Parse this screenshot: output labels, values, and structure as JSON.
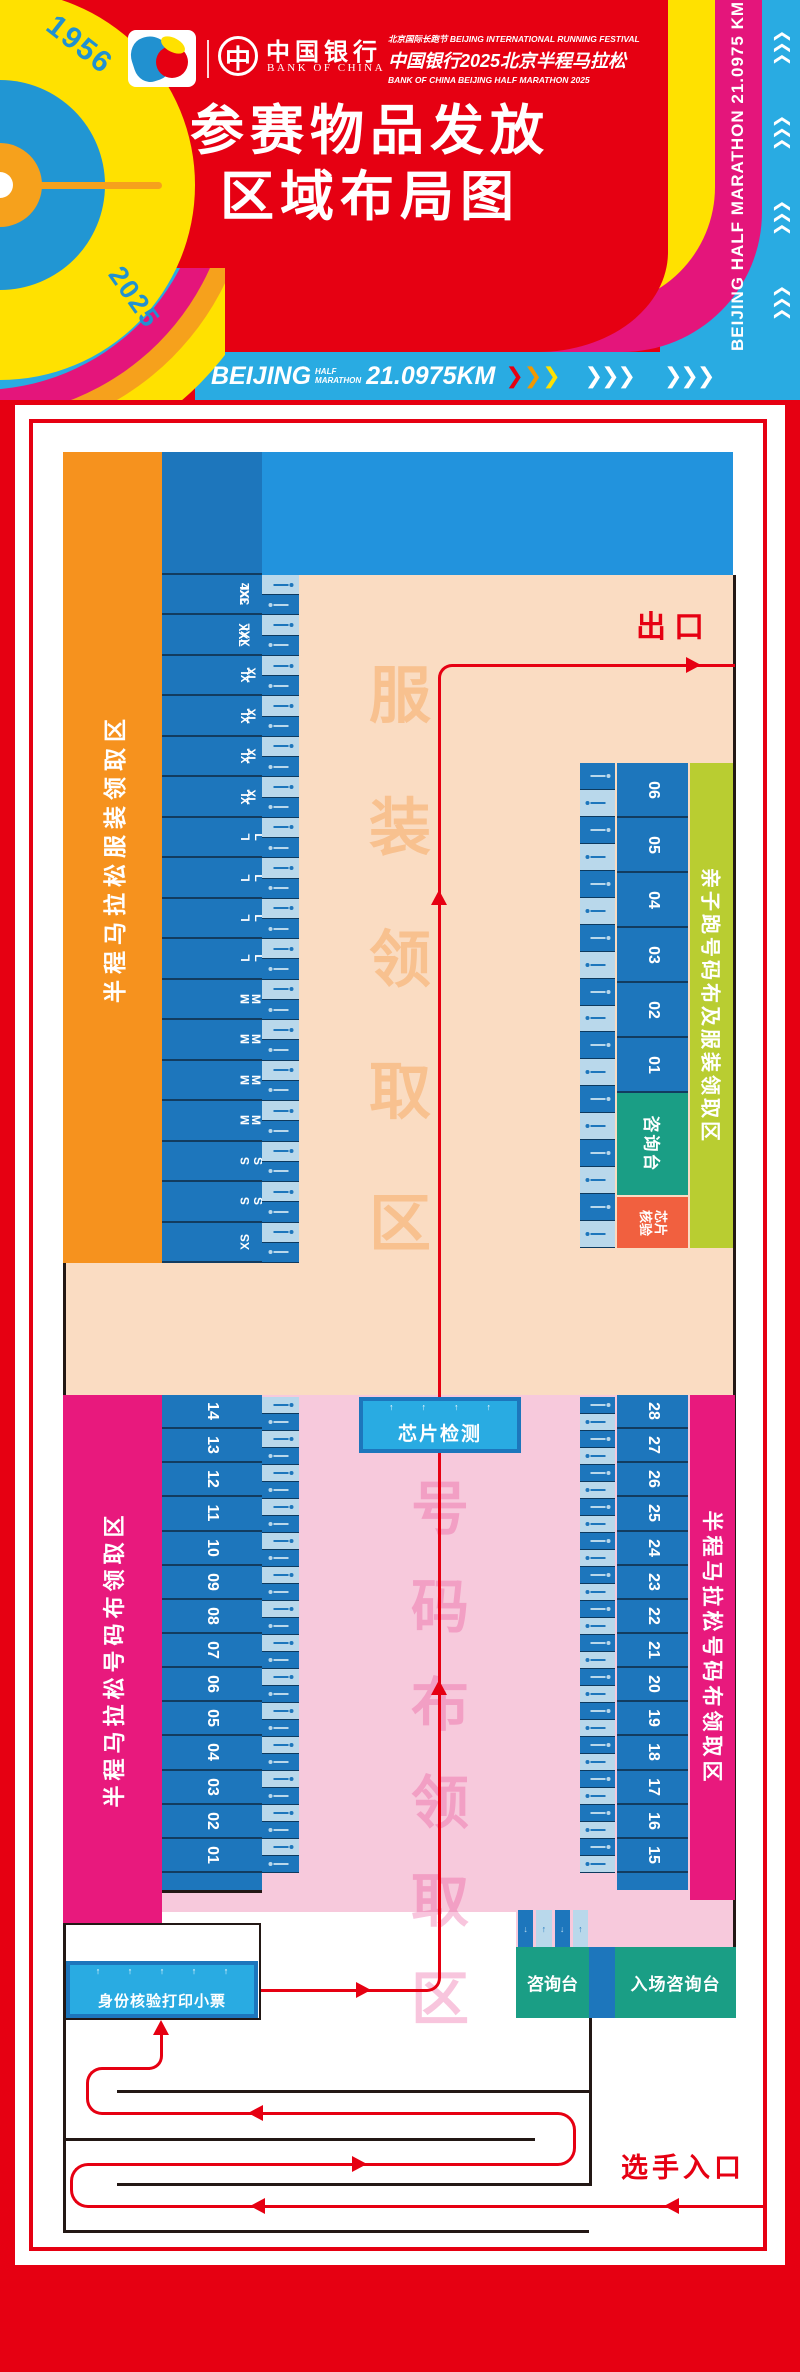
{
  "header": {
    "festival_line_cn": "北京国际长跑节",
    "festival_line_en": "BEIJING INTERNATIONAL RUNNING FESTIVAL",
    "event_line": "中国银行2025北京半程马拉松",
    "event_line_en": "BANK OF CHINA BEIJING HALF MARATHON 2025",
    "boc_symbol": "中",
    "boc_cn": "中国银行",
    "boc_en": "BANK OF CHINA",
    "title_line1": "参赛物品发放",
    "title_line2": "区域布局图",
    "year_start": "1956",
    "year_end": "2025",
    "side_banner_text": "BEIJING HALF MARATHON 21.0975 KM",
    "v_chevrons": [
      "❯❯❯",
      "❯❯❯",
      "❯❯❯",
      "❯❯❯"
    ],
    "banner": {
      "city": "BEIJING",
      "half": "HALF",
      "marathon": "MARATHON",
      "distance": "21.0975KM",
      "chev": "❯",
      "chev3": "❯❯❯"
    }
  },
  "colors": {
    "poster_red": "#e60012",
    "banner_blue": "#29abe2",
    "stall_blue": "#1d76bc",
    "table_light_blue": "#b9d8eb",
    "peach": "#fadcc2",
    "pink": "#f7c9dc",
    "magenta": "#e8197d",
    "orange": "#f6921e",
    "yellow_green": "#b9cd31",
    "teal": "#1a9e85",
    "chip_orange": "#f1603f",
    "yellow": "#ffe100"
  },
  "map": {
    "exit_label": "出口",
    "entrance_label": "选手入口",
    "clothing_zone_label": "半程马拉松服装领取区",
    "clothing_watermark": [
      "服",
      "装",
      "领",
      "取",
      "区"
    ],
    "size_rows": [
      {
        "a": "3XL",
        "b": "4XL"
      },
      {
        "a": "XXL",
        "b": "XXL"
      },
      {
        "a": "XL",
        "b": "XL"
      },
      {
        "a": "XL",
        "b": "XL"
      },
      {
        "a": "XL",
        "b": "XL"
      },
      {
        "a": "XL",
        "b": "XL"
      },
      {
        "a": "L",
        "b": "L"
      },
      {
        "a": "L",
        "b": "L"
      },
      {
        "a": "L",
        "b": "L"
      },
      {
        "a": "L",
        "b": "L"
      },
      {
        "a": "M",
        "b": "M"
      },
      {
        "a": "M",
        "b": "M"
      },
      {
        "a": "M",
        "b": "M"
      },
      {
        "a": "M",
        "b": "M"
      },
      {
        "a": "S",
        "b": "S"
      },
      {
        "a": "S",
        "b": "S"
      },
      {
        "a": "XS",
        "b": ""
      }
    ],
    "family_zone_label": "亲子跑号码布及服装领取区",
    "family_stalls": [
      "06",
      "05",
      "04",
      "03",
      "02",
      "01"
    ],
    "family_tables": [
      "",
      "",
      "",
      "",
      "",
      "",
      "",
      "",
      ""
    ],
    "family_info_desk_label": "咨询台",
    "chip_verify_label": "芯片核验",
    "chip_detect_label": "芯片检测",
    "chip_detect_arrows": [
      "↑",
      "↑",
      "↑",
      "↑"
    ],
    "bib_zone_left_label": "半程马拉松号码布领取区",
    "bib_zone_right_label": "半程马拉松号码布领取区",
    "bib_watermark": [
      "号",
      "码",
      "布",
      "领",
      "取",
      "区"
    ],
    "left_stalls": [
      "14",
      "13",
      "12",
      "11",
      "10",
      "09",
      "08",
      "07",
      "06",
      "05",
      "04",
      "03",
      "02",
      "01"
    ],
    "right_stalls": [
      "28",
      "27",
      "26",
      "25",
      "24",
      "23",
      "22",
      "21",
      "20",
      "19",
      "18",
      "17",
      "16",
      "15"
    ],
    "id_check_label": "身份核验打印小票",
    "id_check_arrows": [
      "↑",
      "↑",
      "↑",
      "↑",
      "↑"
    ],
    "info_desk_label": "咨询台",
    "entrance_info_desk_label": "入场咨询台",
    "desk_table_arrows": [
      "↓",
      "↑",
      "↓",
      "↑"
    ]
  }
}
